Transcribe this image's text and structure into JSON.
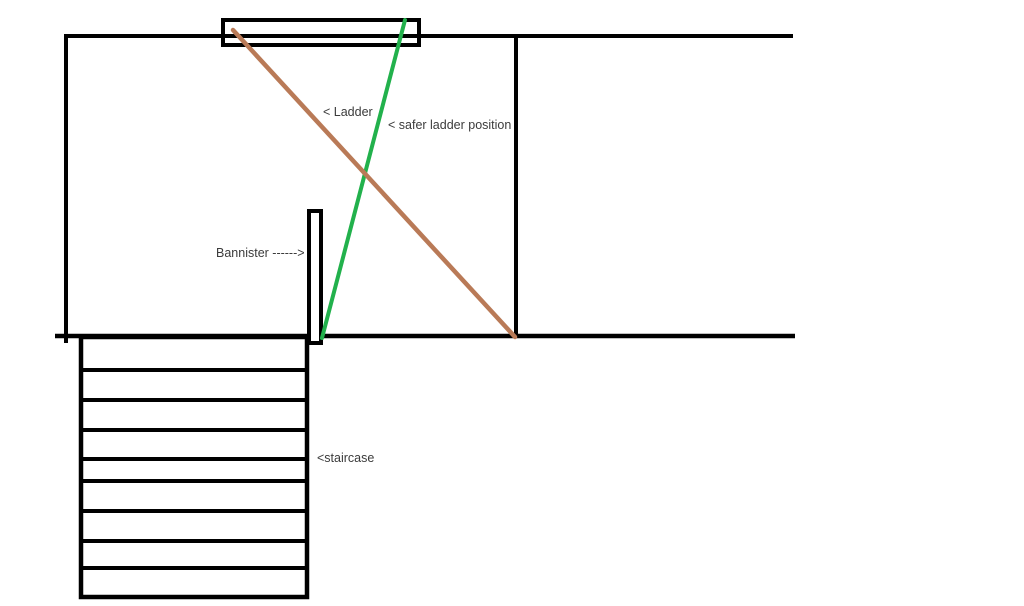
{
  "diagram": {
    "background": "#ffffff",
    "structure_color": "#000000",
    "text_color": "#3b3b3b",
    "ladder": {
      "label": "< Ladder",
      "color": "#b97a57"
    },
    "safer_ladder": {
      "label": "< safer ladder position",
      "color": "#22b14c"
    },
    "bannister": {
      "label": "Bannister ------>"
    },
    "staircase": {
      "label": "<staircase",
      "step_count": 9
    }
  }
}
